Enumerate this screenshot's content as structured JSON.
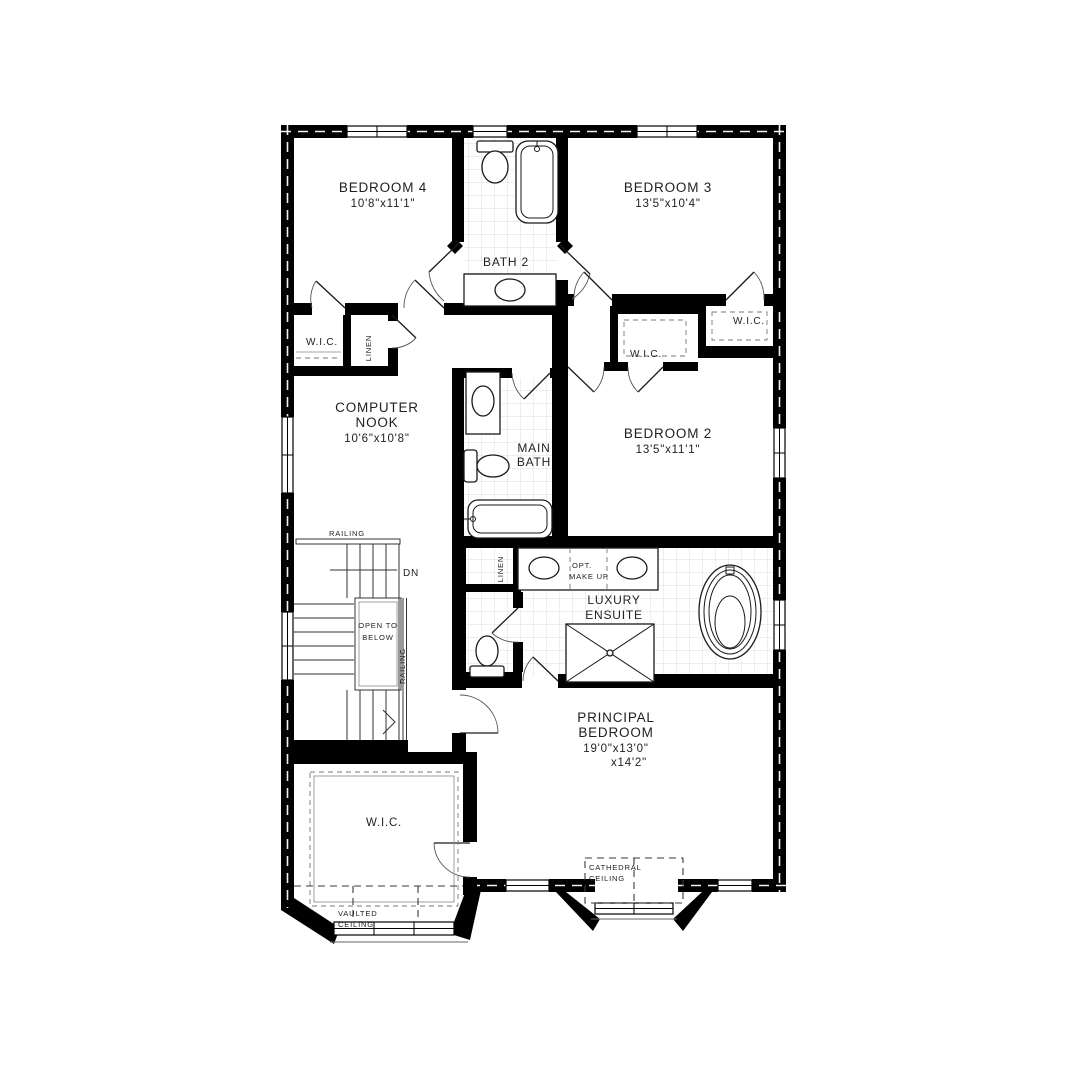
{
  "plan": {
    "labels": {
      "bedroom4_name": "BEDROOM 4",
      "bedroom4_dims": "10'8\"x11'1\"",
      "bedroom3_name": "BEDROOM 3",
      "bedroom3_dims": "13'5\"x10'4\"",
      "bath2_name": "BATH 2",
      "bedroom2_name": "BEDROOM 2",
      "bedroom2_dims": "13'5\"x11'1\"",
      "computer_nook_1": "COMPUTER",
      "computer_nook_2": "NOOK",
      "computer_nook_dims": "10'6\"x10'8\"",
      "main_bath_1": "MAIN",
      "main_bath_2": "BATH",
      "luxury_ensuite_1": "LUXURY",
      "luxury_ensuite_2": "ENSUITE",
      "principal_1": "PRINCIPAL",
      "principal_2": "BEDROOM",
      "principal_dims_1": "19'0\"x13'0\"",
      "principal_dims_2": "x14'2\"",
      "wic": "W.I.C.",
      "linen": "LINEN",
      "railing": "RAILING",
      "dn": "DN",
      "open_below_1": "OPEN TO",
      "open_below_2": "BELOW",
      "opt_makeup_1": "OPT.",
      "opt_makeup_2": "MAKE UP",
      "vaulted_1": "VAULTED",
      "vaulted_2": "CEILING",
      "cathedral_1": "CATHEDRAL",
      "cathedral_2": "CEILING"
    },
    "colors": {
      "wall": "#000000",
      "line": "#1a1a1a",
      "tile": "#d4d4d4",
      "text": "#1f1f1f",
      "bg": "#ffffff"
    }
  }
}
